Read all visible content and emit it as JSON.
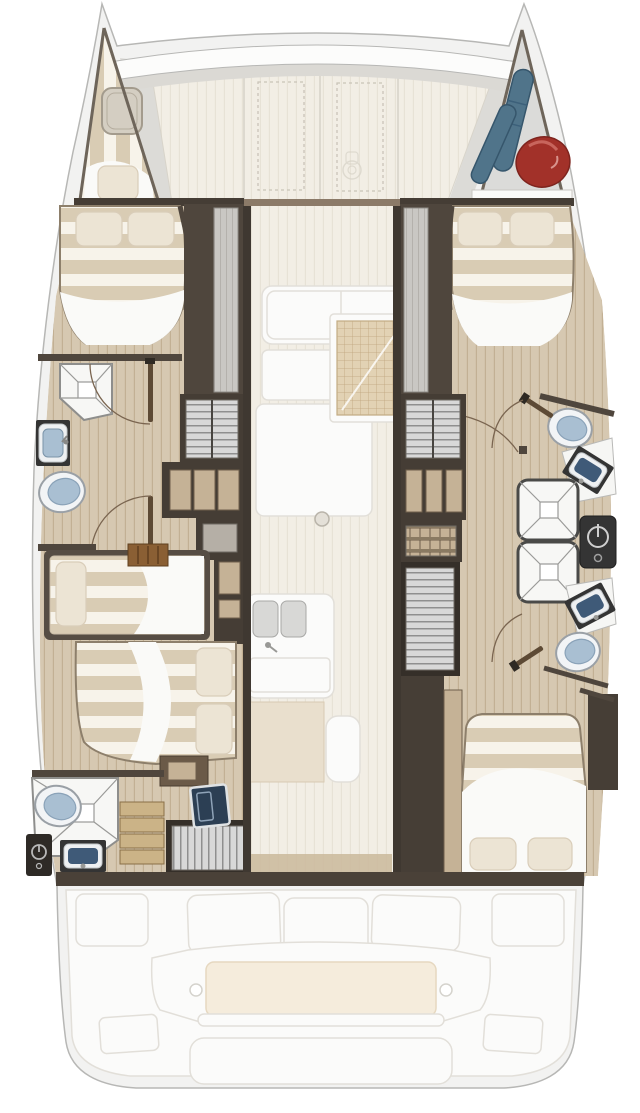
{
  "palette": {
    "hull_gray": "#f2f2f1",
    "hull_line": "#b7b7b5",
    "rim_gray": "#dcdbd7",
    "deck_white": "#f2efe7",
    "ghost_fill": "#fbfbfa",
    "ghost_line": "#e2dfd9",
    "joinery_dark": "#453d35",
    "joinery_deep": "#352f29",
    "wall_brown": "#4f463d",
    "wood_tan": "#c5b296",
    "wood_drawer": "#cbb387",
    "floor_plank": "#d6c8b1",
    "plank_line": "#c2b094",
    "floor_pale": "#f2eee5",
    "pale_line": "#e7e2d6",
    "mattress_stripe": "#d9ccb4",
    "mattress_light": "#f7f3ea",
    "pillow": "#ece4d4",
    "sheet_white": "#fafaf8",
    "fixture_blue": "#a9bfd2",
    "basin_navy": "#3f5a78",
    "shower_white": "#f7f7f5",
    "cushion": "#f5ecdc",
    "fender_blue": "#50748a",
    "bag_red": "#a23129",
    "door_wood": "#5d4a35",
    "arc_line": "#7a6550",
    "grid_tan": "#e2d2b4",
    "grid_line": "#bfa47c",
    "rib_bg": "#d8d8d8",
    "rib_line": "#8f8f8f",
    "appliance_black": "#343434",
    "navy_hatch": "#2c3f54"
  },
  "plan": {
    "type": "catamaran-deck-plan",
    "orientation": "bow-up",
    "foredeck": {
      "hatch_count": 2,
      "has_windlass": true,
      "has_crossbeam": true
    },
    "port_hull": {
      "forepeak": {
        "berth": "single",
        "pillow_count": 1,
        "hatch": true
      },
      "forward_cabin": {
        "bed": "double",
        "pillow_count": 2,
        "wardrobe": true
      },
      "forward_bathroom": {
        "shower": true,
        "sink": true,
        "toilet": true,
        "door_count": 2
      },
      "hanging_locker": true,
      "cubby_count": 3,
      "mid_berth": {
        "bed": "single",
        "pillow_count": 1,
        "ladder": true
      },
      "aft_cabin": {
        "bed": "double",
        "pillow_count": 2,
        "nightstand": true
      },
      "aft_bathroom": {
        "shower": true,
        "sink": true,
        "toilet": true,
        "locker": true,
        "drawer_count": 4,
        "stairs": true
      }
    },
    "starboard_hull": {
      "bow_locker": {
        "contents": [
          "fender",
          "fender",
          "duffel-bag"
        ],
        "shelf": true
      },
      "forward_cabin": {
        "bed": "double",
        "pillow_count": 2,
        "wardrobe": true
      },
      "forward_bathroom": {
        "toilet": true,
        "sink": true,
        "shower": true,
        "door_count": 2
      },
      "aft_bathroom": {
        "toilet": true,
        "sink": true,
        "shower": true,
        "door_count": 1
      },
      "water_heater": true,
      "hanging_locker": true,
      "cubby_count": 3,
      "companionway_stairs": true,
      "shelf_slats": true,
      "aft_cabin": {
        "bed": "double",
        "pillow_count": 2,
        "closet": true
      }
    },
    "saloon_ghost": {
      "items": [
        "galley-counter",
        "chart-table-mat",
        "double-sink",
        "table",
        "bench",
        "support-post"
      ]
    },
    "cockpit_ghost": {
      "seat_count": 3,
      "side_bench_count": 2,
      "bench_cushion": true,
      "cup_holder_count": 2,
      "swim_platform": true
    }
  }
}
